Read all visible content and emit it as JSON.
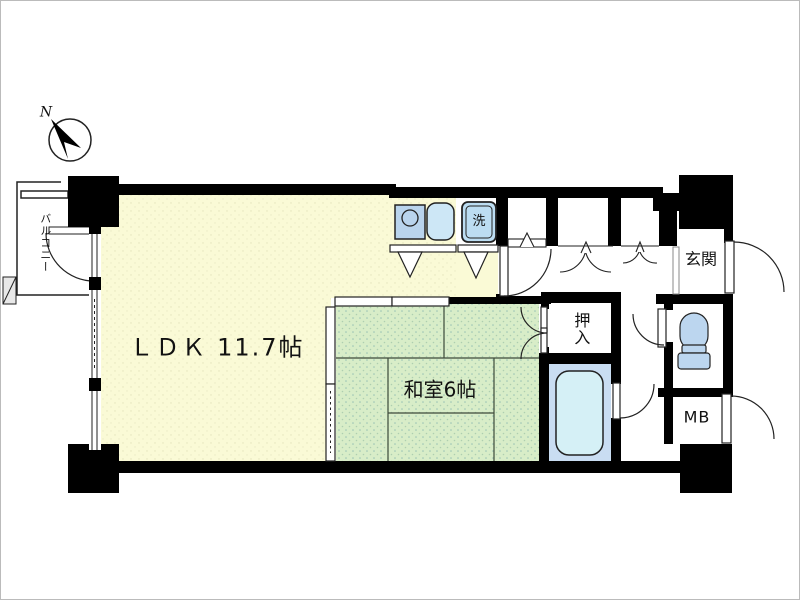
{
  "floorplan": {
    "compass": {
      "label": "N"
    },
    "balcony": {
      "label": "バルコニー"
    },
    "rooms": {
      "ldk": {
        "label": "ＬＤＫ 11.7帖",
        "color": "#FAFAD6"
      },
      "washitsu": {
        "label": "和室6帖",
        "color": "#D8EDC8"
      },
      "oshiire": {
        "label": "押入"
      },
      "bathroom": {
        "floor_color": "#C9DDF2"
      },
      "genkan": {
        "label": "玄関"
      },
      "meter_box": {
        "label": "MB"
      },
      "laundry": {
        "label": "洗"
      }
    },
    "fixtures": {
      "kitchen_stove": {
        "name": "stove-burner",
        "color": "#B9D4ED"
      },
      "kitchen_sink": {
        "name": "kitchen-sink",
        "color": "#CDE7F6"
      },
      "washing_machine": {
        "name": "washing-machine",
        "color": "#BCDDF2"
      },
      "bathtub": {
        "name": "bathtub",
        "color": "#D5F0F6"
      },
      "toilet": {
        "name": "toilet",
        "color": "#BCD6EF"
      }
    },
    "wall_color": "#000000"
  }
}
